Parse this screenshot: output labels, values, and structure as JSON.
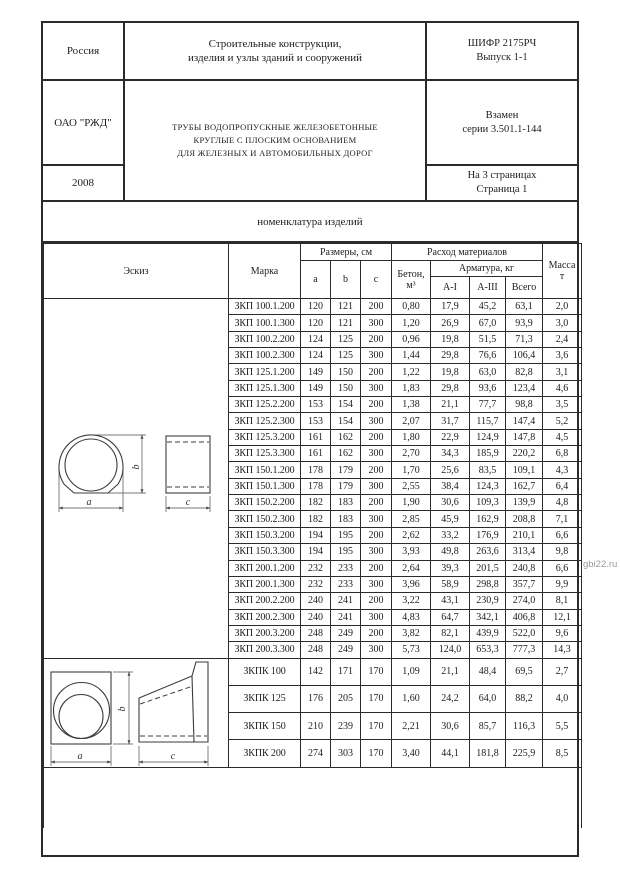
{
  "colors": {
    "line": "#2b2b2b",
    "watermark": "#9a9a9a",
    "paper": "#ffffff"
  },
  "title_block": {
    "country": "Россия",
    "organization": "ОАО \"РЖД\"",
    "year": "2008",
    "subject_line1": "Строительные конструкции,",
    "subject_line2": "изделия и узлы зданий и сооружений",
    "doc_title_line1": "ТРУБЫ ВОДОПРОПУСКНЫЕ ЖЕЛЕЗОБЕТОННЫЕ",
    "doc_title_line2": "КРУГЛЫЕ С ПЛОСКИМ ОСНОВАНИЕМ",
    "doc_title_line3": "ДЛЯ ЖЕЛЕЗНЫХ И АВТОМОБИЛЬНЫХ ДОРОГ",
    "cipher_line1": "ШИФР 2175РЧ",
    "cipher_line2": "Выпуск 1-1",
    "replaces_line1": "Взамен",
    "replaces_line2": "серии 3.501.1-144",
    "pages_line1": "На 3 страницах",
    "pages_line2": "Страница 1"
  },
  "section_title": "номенклатура изделий",
  "table": {
    "headers": {
      "sketch": "Эскиз",
      "mark": "Марка",
      "dimensions_group": "Размеры, см",
      "dim_a": "a",
      "dim_b": "b",
      "dim_c": "c",
      "materials_group": "Расход материалов",
      "concrete_line1": "Бетон,",
      "concrete_line2": "м³",
      "rebar_group": "Арматура, кг",
      "rebar_ai": "A-I",
      "rebar_aiii": "A-III",
      "rebar_total": "Всего",
      "mass_line1": "Масса",
      "mass_line2": "т"
    },
    "zkp_rows": [
      [
        "ЗКП 100.1.200",
        "120",
        "121",
        "200",
        "0,80",
        "17,9",
        "45,2",
        "63,1",
        "2,0"
      ],
      [
        "ЗКП 100.1.300",
        "120",
        "121",
        "300",
        "1,20",
        "26,9",
        "67,0",
        "93,9",
        "3,0"
      ],
      [
        "ЗКП 100.2.200",
        "124",
        "125",
        "200",
        "0,96",
        "19,8",
        "51,5",
        "71,3",
        "2,4"
      ],
      [
        "ЗКП 100.2.300",
        "124",
        "125",
        "300",
        "1,44",
        "29,8",
        "76,6",
        "106,4",
        "3,6"
      ],
      [
        "ЗКП 125.1.200",
        "149",
        "150",
        "200",
        "1,22",
        "19,8",
        "63,0",
        "82,8",
        "3,1"
      ],
      [
        "ЗКП 125.1.300",
        "149",
        "150",
        "300",
        "1,83",
        "29,8",
        "93,6",
        "123,4",
        "4,6"
      ],
      [
        "ЗКП 125.2.200",
        "153",
        "154",
        "200",
        "1,38",
        "21,1",
        "77,7",
        "98,8",
        "3,5"
      ],
      [
        "ЗКП 125.2.300",
        "153",
        "154",
        "300",
        "2,07",
        "31,7",
        "115,7",
        "147,4",
        "5,2"
      ],
      [
        "ЗКП 125.3.200",
        "161",
        "162",
        "200",
        "1,80",
        "22,9",
        "124,9",
        "147,8",
        "4,5"
      ],
      [
        "ЗКП 125.3.300",
        "161",
        "162",
        "300",
        "2,70",
        "34,3",
        "185,9",
        "220,2",
        "6,8"
      ],
      [
        "ЗКП 150.1.200",
        "178",
        "179",
        "200",
        "1,70",
        "25,6",
        "83,5",
        "109,1",
        "4,3"
      ],
      [
        "ЗКП 150.1.300",
        "178",
        "179",
        "300",
        "2,55",
        "38,4",
        "124,3",
        "162,7",
        "6,4"
      ],
      [
        "ЗКП 150.2.200",
        "182",
        "183",
        "200",
        "1,90",
        "30,6",
        "109,3",
        "139,9",
        "4,8"
      ],
      [
        "ЗКП 150.2.300",
        "182",
        "183",
        "300",
        "2,85",
        "45,9",
        "162,9",
        "208,8",
        "7,1"
      ],
      [
        "ЗКП 150.3.200",
        "194",
        "195",
        "200",
        "2,62",
        "33,2",
        "176,9",
        "210,1",
        "6,6"
      ],
      [
        "ЗКП 150.3.300",
        "194",
        "195",
        "300",
        "3,93",
        "49,8",
        "263,6",
        "313,4",
        "9,8"
      ],
      [
        "ЗКП 200.1.200",
        "232",
        "233",
        "200",
        "2,64",
        "39,3",
        "201,5",
        "240,8",
        "6,6"
      ],
      [
        "ЗКП 200.1.300",
        "232",
        "233",
        "300",
        "3,96",
        "58,9",
        "298,8",
        "357,7",
        "9,9"
      ],
      [
        "ЗКП 200.2.200",
        "240",
        "241",
        "200",
        "3,22",
        "43,1",
        "230,9",
        "274,0",
        "8,1"
      ],
      [
        "ЗКП 200.2.300",
        "240",
        "241",
        "300",
        "4,83",
        "64,7",
        "342,1",
        "406,8",
        "12,1"
      ],
      [
        "ЗКП 200.3.200",
        "248",
        "249",
        "200",
        "3,82",
        "82,1",
        "439,9",
        "522,0",
        "9,6"
      ],
      [
        "ЗКП 200.3.300",
        "248",
        "249",
        "300",
        "5,73",
        "124,0",
        "653,3",
        "777,3",
        "14,3"
      ]
    ],
    "zkpk_rows": [
      [
        "ЗКПК 100",
        "142",
        "171",
        "170",
        "1,09",
        "21,1",
        "48,4",
        "69,5",
        "2,7"
      ],
      [
        "ЗКПК 125",
        "176",
        "205",
        "170",
        "1,60",
        "24,2",
        "64,0",
        "88,2",
        "4,0"
      ],
      [
        "ЗКПК 150",
        "210",
        "239",
        "170",
        "2,21",
        "30,6",
        "85,7",
        "116,3",
        "5,5"
      ],
      [
        "ЗКПК 200",
        "274",
        "303",
        "170",
        "3,40",
        "44,1",
        "181,8",
        "225,9",
        "8,5"
      ]
    ]
  },
  "sketches": {
    "label_a": "a",
    "label_b": "b",
    "label_c": "c"
  },
  "watermark": "gbi22.ru"
}
